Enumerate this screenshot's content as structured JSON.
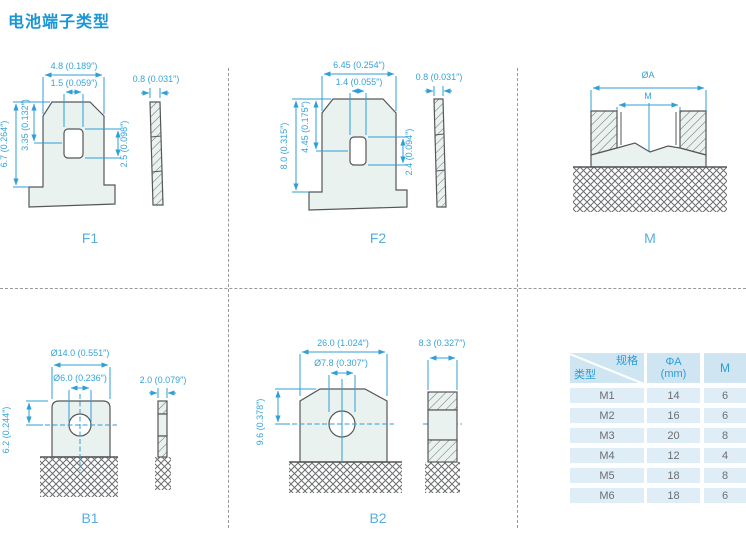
{
  "title": "电池端子类型",
  "drawings": {
    "f1": {
      "label": "F1",
      "dim_width": "4.8 (0.189″)",
      "dim_slot_w": "1.5 (0.059″)",
      "dim_height": "6.7 (0.264″)",
      "dim_half": "3.35 (0.132″)",
      "dim_slot_h": "2.5 (0.098″)",
      "dim_thick": "0.8 (0.031″)"
    },
    "f2": {
      "label": "F2",
      "dim_width": "6.45 (0.254″)",
      "dim_slot_w": "1.4 (0.055″)",
      "dim_height": "8.0 (0.315″)",
      "dim_half": "4.45 (0.175″)",
      "dim_slot_h": "2.4 (0.094″)",
      "dim_thick": "0.8 (0.031″)"
    },
    "m": {
      "label": "M",
      "dim_outer": "ØA",
      "dim_thread": "M"
    },
    "b1": {
      "label": "B1",
      "dim_width": "Ø14.0 (0.551″)",
      "dim_hole": "Ø6.0 (0.236″)",
      "dim_height": "6.2 (0.244″)",
      "dim_thick": "2.0 (0.079″)"
    },
    "b2": {
      "label": "B2",
      "dim_width": "26.0 (1.024″)",
      "dim_hole": "Ø7.8 (0.307″)",
      "dim_height": "9.6 (0.378″)",
      "dim_thick": "8.3 (0.327″)"
    }
  },
  "table": {
    "header": {
      "spec": "规格",
      "type": "类型",
      "col_a_line1": "ΦA",
      "col_a_line2": "(mm)",
      "col_m": "M"
    },
    "rows": [
      {
        "type": "M1",
        "a": "14",
        "m": "6"
      },
      {
        "type": "M2",
        "a": "16",
        "m": "6"
      },
      {
        "type": "M3",
        "a": "20",
        "m": "8"
      },
      {
        "type": "M4",
        "a": "12",
        "m": "4"
      },
      {
        "type": "M5",
        "a": "18",
        "m": "8"
      },
      {
        "type": "M6",
        "a": "18",
        "m": "6"
      }
    ]
  },
  "colors": {
    "accent": "#2f9fd7",
    "outline": "#55575a",
    "part_fill": "#e9f2ef",
    "table_header_bg": "#cfe6f2",
    "table_row_bg": "#dfeef6"
  }
}
